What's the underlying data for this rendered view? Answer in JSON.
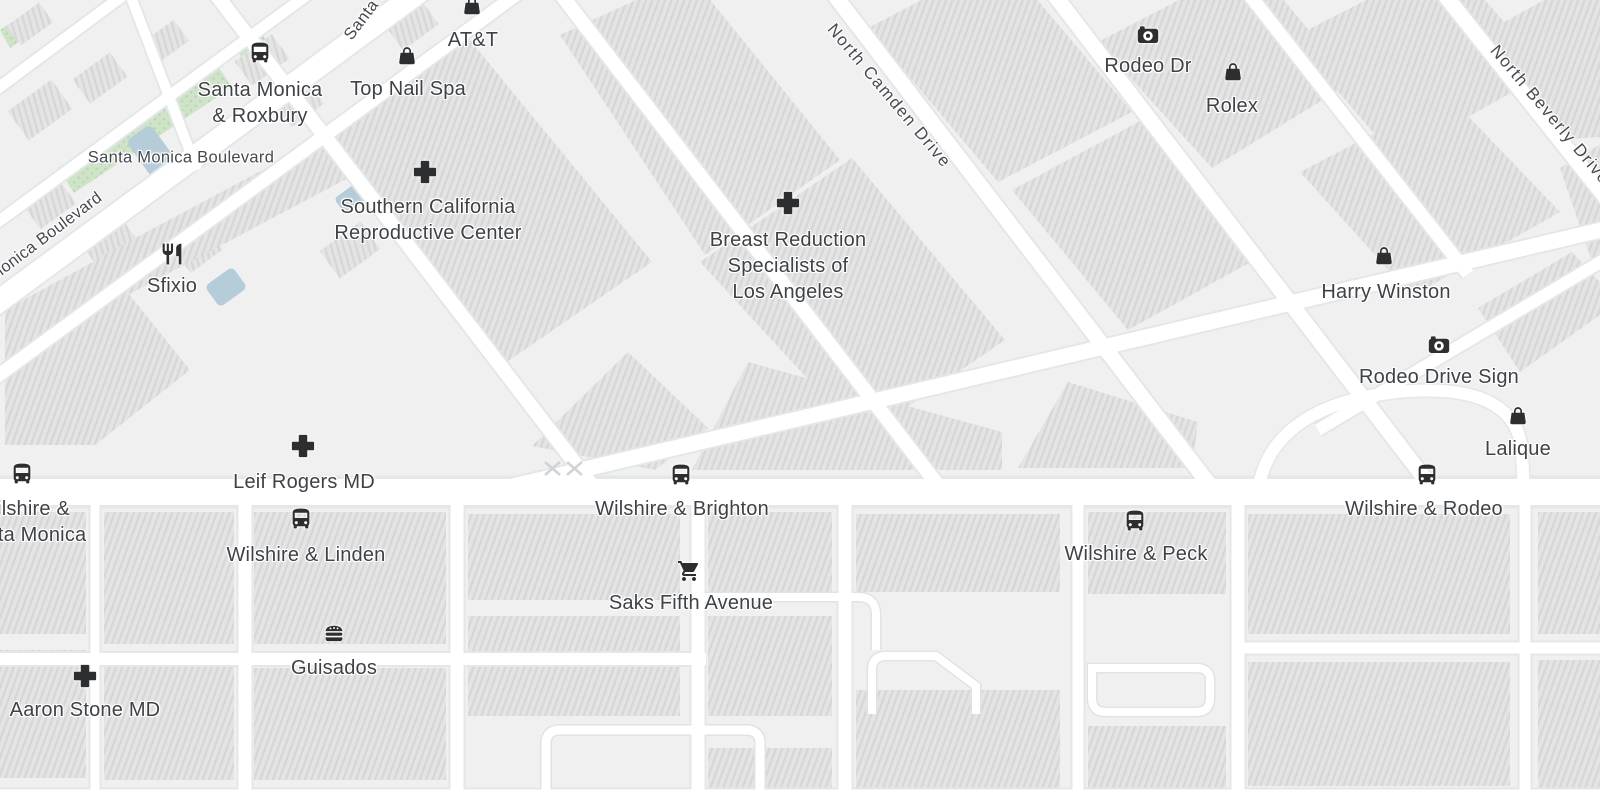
{
  "map": {
    "colors": {
      "bg": "#f0f0f1",
      "road": "#ffffff",
      "casing": "#e3e7e8",
      "building": "#e4e4e5",
      "hatch": "#d6d6d7",
      "park": "#cfe3c8",
      "parkdot": "#b7d2ac",
      "water": "#b5ccd9",
      "label": "#3e4247",
      "streetlabel": "#46494f",
      "icon": "#2d2e30"
    },
    "pois": [
      {
        "id": "santa-monica-roxbury",
        "icon": "bus-icon",
        "icon_x": 260,
        "icon_y": 53,
        "label_x": 260,
        "label_y": 77,
        "lines": [
          "Santa Monica",
          "& Roxbury"
        ]
      },
      {
        "id": "top-nail-spa",
        "icon": "bag-icon",
        "icon_x": 407,
        "icon_y": 56,
        "label_x": 408,
        "label_y": 76,
        "lines": [
          "Top Nail Spa"
        ]
      },
      {
        "id": "att",
        "icon": "bag-icon",
        "icon_x": 472,
        "icon_y": 6,
        "label_x": 473,
        "label_y": 27,
        "lines": [
          "AT&T"
        ]
      },
      {
        "id": "sfixio",
        "icon": "restaurant-icon",
        "icon_x": 172,
        "icon_y": 254,
        "label_x": 172,
        "label_y": 273,
        "lines": [
          "Sfixio"
        ]
      },
      {
        "id": "southern-california-reproductive-center",
        "icon": "cross-icon",
        "icon_x": 425,
        "icon_y": 172,
        "label_x": 428,
        "label_y": 194,
        "lines": [
          "Southern California",
          "Reproductive Center"
        ]
      },
      {
        "id": "breast-reduction-specialists",
        "icon": "cross-icon",
        "icon_x": 788,
        "icon_y": 203,
        "label_x": 788,
        "label_y": 227,
        "lines": [
          "Breast Reduction",
          "Specialists of",
          "Los Angeles"
        ]
      },
      {
        "id": "rodeo-dr",
        "icon": "camera-icon",
        "icon_x": 1148,
        "icon_y": 35,
        "label_x": 1148,
        "label_y": 53,
        "lines": [
          "Rodeo Dr"
        ]
      },
      {
        "id": "rolex",
        "icon": "bag-icon",
        "icon_x": 1233,
        "icon_y": 72,
        "label_x": 1232,
        "label_y": 93,
        "lines": [
          "Rolex"
        ]
      },
      {
        "id": "harry-winston",
        "icon": "bag-icon",
        "icon_x": 1384,
        "icon_y": 256,
        "label_x": 1386,
        "label_y": 279,
        "lines": [
          "Harry Winston"
        ]
      },
      {
        "id": "rodeo-drive-sign",
        "icon": "camera-icon",
        "icon_x": 1439,
        "icon_y": 345,
        "label_x": 1439,
        "label_y": 364,
        "lines": [
          "Rodeo Drive Sign"
        ]
      },
      {
        "id": "lalique",
        "icon": "bag-icon",
        "icon_x": 1518,
        "icon_y": 416,
        "label_x": 1518,
        "label_y": 436,
        "lines": [
          "Lalique"
        ]
      },
      {
        "id": "leif-rogers-md",
        "icon": "cross-icon",
        "icon_x": 303,
        "icon_y": 446,
        "label_x": 304,
        "label_y": 469,
        "lines": [
          "Leif Rogers MD"
        ]
      },
      {
        "id": "wilshire-santa-monica",
        "icon": "bus-icon",
        "icon_x": 22,
        "icon_y": 474,
        "label_x": 24,
        "label_y": 496,
        "lines": [
          "Wilshire &",
          "Santa Monica"
        ]
      },
      {
        "id": "wilshire-linden",
        "icon": "bus-icon",
        "icon_x": 301,
        "icon_y": 519,
        "label_x": 306,
        "label_y": 542,
        "lines": [
          "Wilshire & Linden"
        ]
      },
      {
        "id": "wilshire-brighton",
        "icon": "bus-icon",
        "icon_x": 681,
        "icon_y": 475,
        "label_x": 682,
        "label_y": 496,
        "lines": [
          "Wilshire & Brighton"
        ]
      },
      {
        "id": "saks-fifth-avenue",
        "icon": "cart-icon",
        "icon_x": 689,
        "icon_y": 571,
        "label_x": 691,
        "label_y": 590,
        "lines": [
          "Saks Fifth Avenue"
        ]
      },
      {
        "id": "wilshire-peck",
        "icon": "bus-icon",
        "icon_x": 1135,
        "icon_y": 521,
        "label_x": 1136,
        "label_y": 541,
        "lines": [
          "Wilshire & Peck"
        ]
      },
      {
        "id": "wilshire-rodeo",
        "icon": "bus-icon",
        "icon_x": 1427,
        "icon_y": 475,
        "label_x": 1424,
        "label_y": 496,
        "lines": [
          "Wilshire & Rodeo"
        ]
      },
      {
        "id": "guisados",
        "icon": "burger-icon",
        "icon_x": 334,
        "icon_y": 633,
        "label_x": 334,
        "label_y": 655,
        "lines": [
          "Guisados"
        ]
      },
      {
        "id": "aaron-stone-md",
        "icon": "cross-icon",
        "icon_x": 85,
        "icon_y": 676,
        "label_x": 85,
        "label_y": 697,
        "lines": [
          "Aaron Stone MD"
        ]
      }
    ],
    "street_labels": [
      {
        "id": "santa-monica-boulevard",
        "text": "Santa Monica Boulevard",
        "x": 181,
        "y": 158,
        "rotation": 0,
        "font_size": 16.5,
        "letter_spacing": 0.3
      },
      {
        "id": "santa-monica-boulevard-diagonal",
        "text": "Santa Monica Boulevard",
        "x": 26,
        "y": 252,
        "rotation": -37,
        "font_size": 16.5,
        "letter_spacing": 0.3
      },
      {
        "id": "santa-monica-blvd-top",
        "text": "Santa Monica Blvd",
        "x": 392,
        "y": -20,
        "rotation": -53,
        "font_size": 16.5,
        "letter_spacing": 0.5
      },
      {
        "id": "north-camden-drive",
        "text": "North Camden Drive",
        "x": 889,
        "y": 96,
        "rotation": 50,
        "font_size": 17,
        "letter_spacing": 1.5
      },
      {
        "id": "north-beverly-drive",
        "text": "North Beverly Drive",
        "x": 1550,
        "y": 115,
        "rotation": 50,
        "font_size": 17,
        "letter_spacing": 1.5
      }
    ]
  }
}
